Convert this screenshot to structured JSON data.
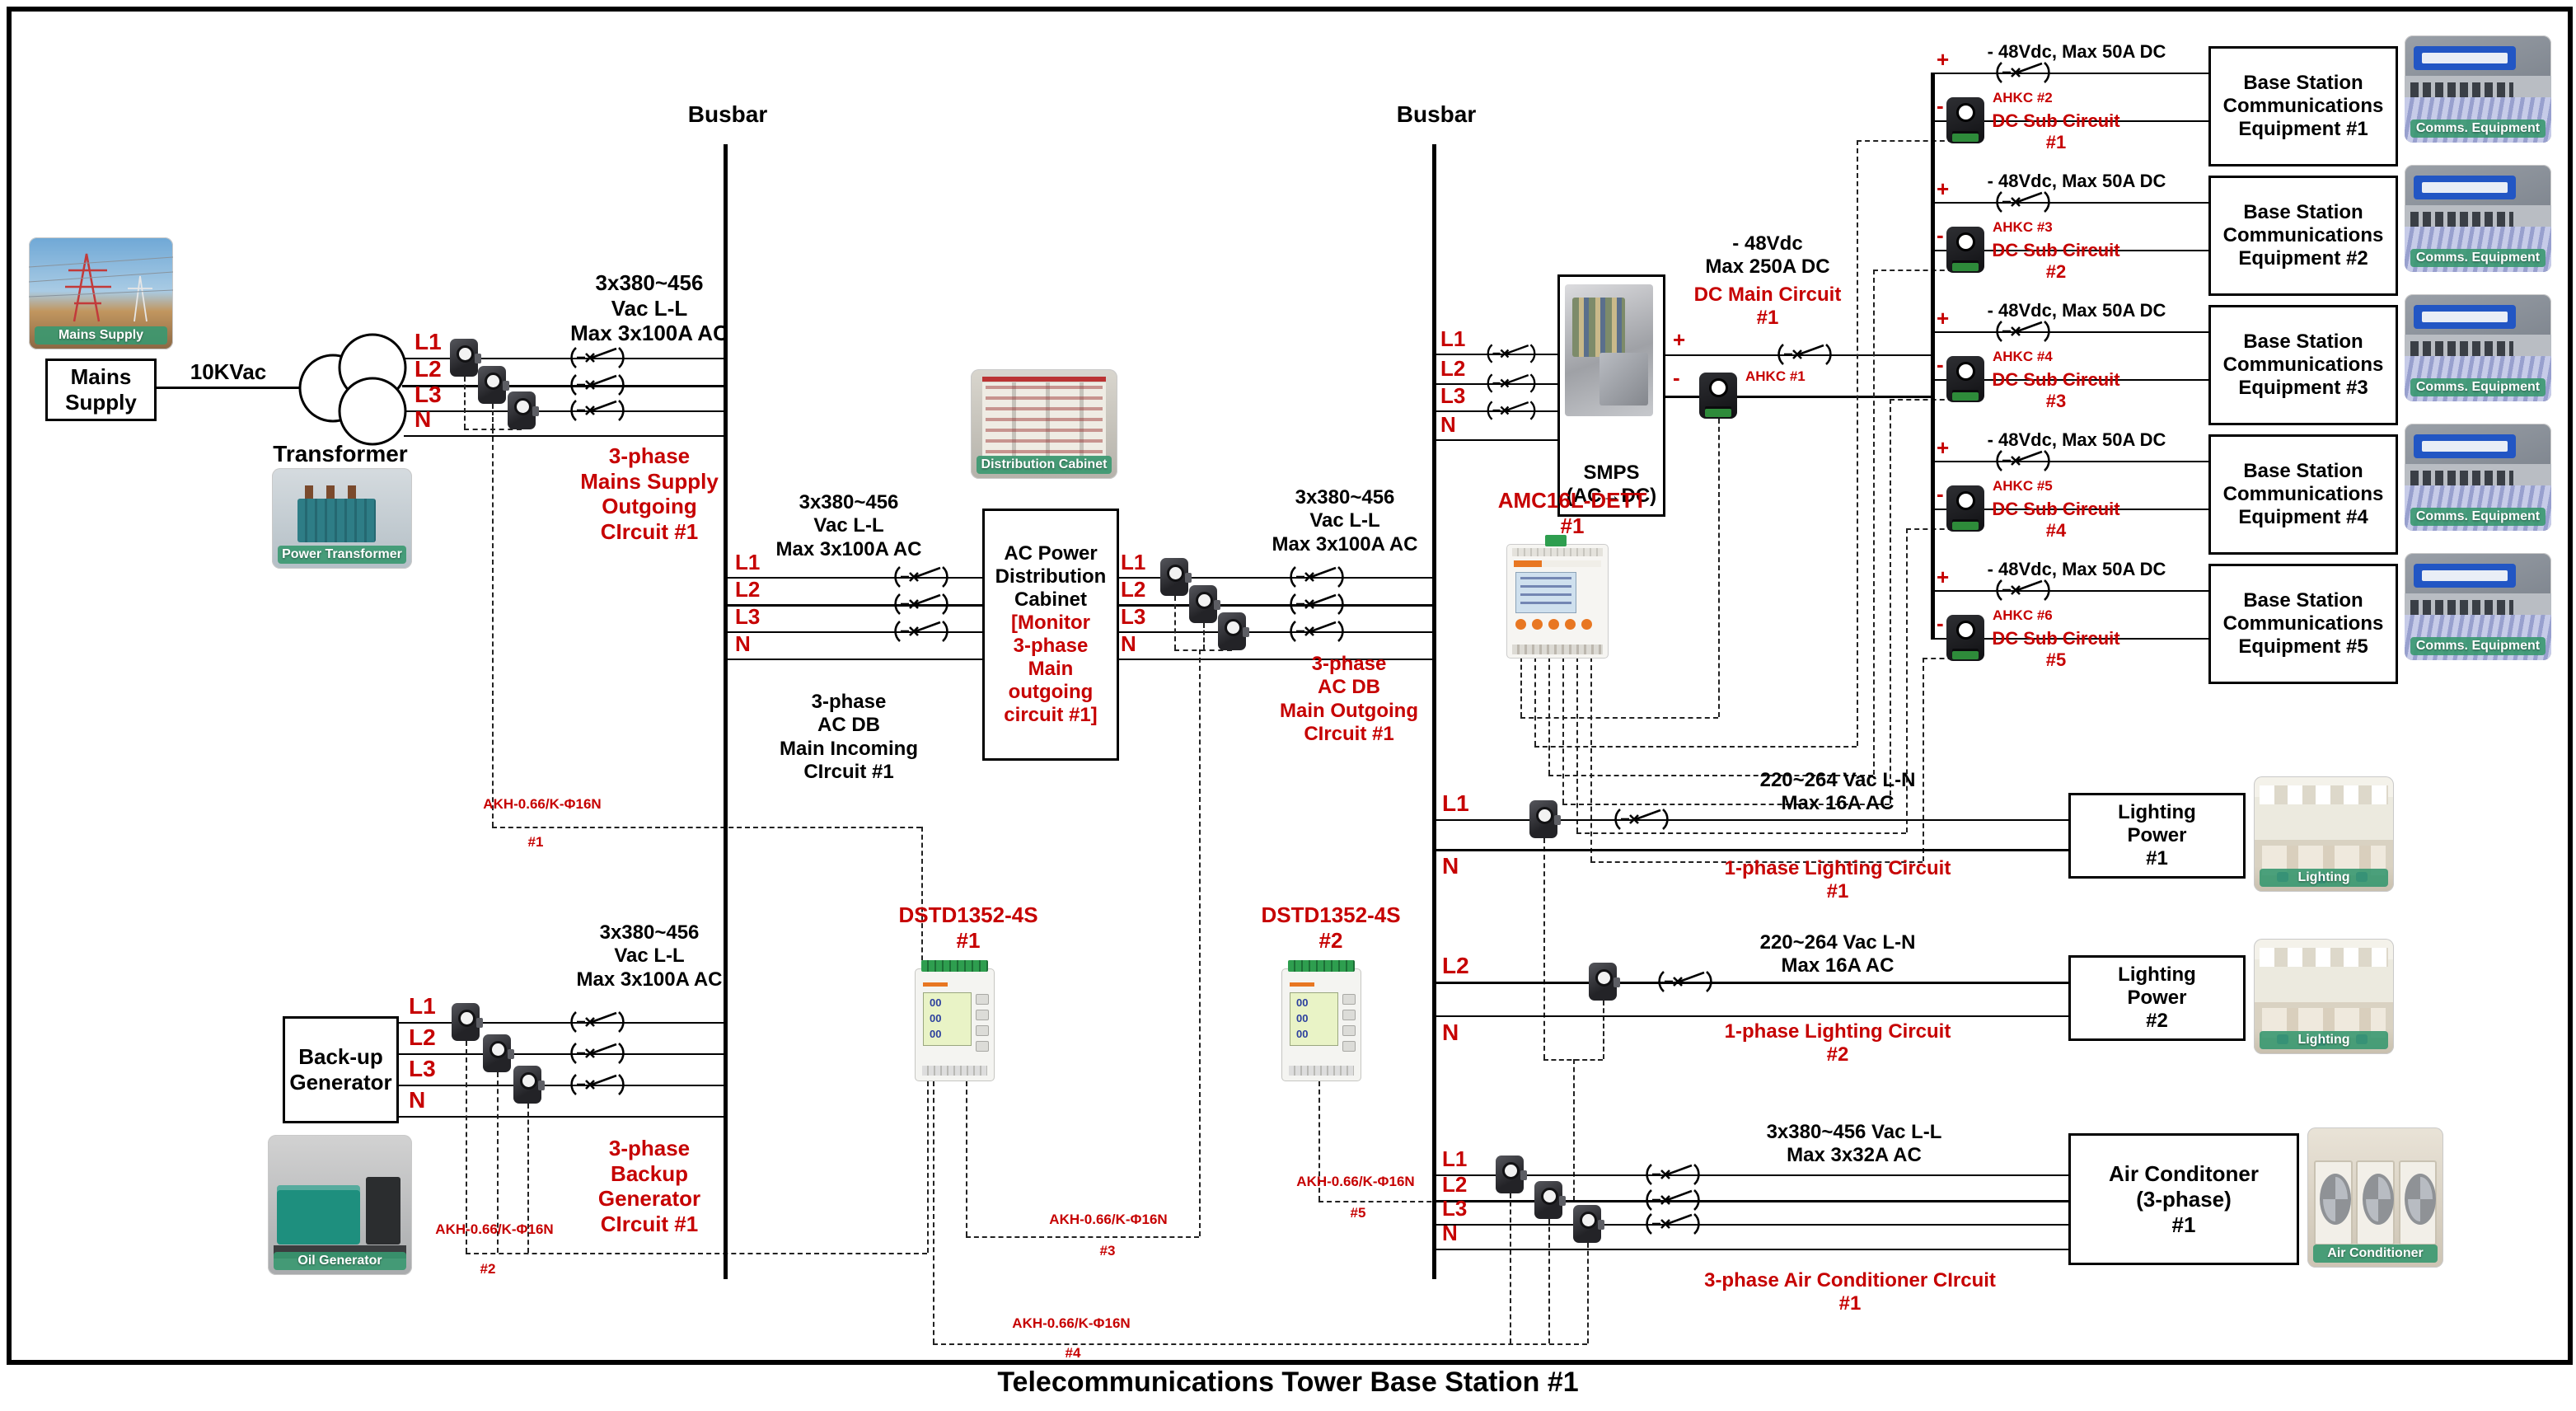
{
  "title": "Telecommunications Tower Base Station #1",
  "busbars": {
    "left": "Busbar",
    "right": "Busbar"
  },
  "mains": {
    "photo_caption": "Mains Supply",
    "source_box": "Mains\nSupply",
    "voltage": "10KVac",
    "transformer_label": "Transformer",
    "transformer_photo_caption": "Power Transformer",
    "l1": "L1",
    "l2": "L2",
    "l3": "L3",
    "n": "N",
    "rating": "3x380~456\nVac L-L\nMax 3x100A AC",
    "outgoing_label": "3-phase\nMains Supply\nOutgoing\nCIrcuit #1",
    "ct_label": "AKH-0.66/K-Φ16N",
    "ct_number": "#1"
  },
  "generator": {
    "box": "Back-up\nGenerator",
    "photo_caption": "Oil Generator",
    "l1": "L1",
    "l2": "L2",
    "l3": "L3",
    "n": "N",
    "rating": "3x380~456\nVac L-L\nMax 3x100A AC",
    "label": "3-phase\nBackup\nGenerator\nCIrcuit #1",
    "ct_label": "AKH-0.66/K-Φ16N",
    "ct_number": "#2"
  },
  "ac_db": {
    "photo_caption": "Distribution Cabinet",
    "box_title": "AC Power\nDistribution\nCabinet",
    "box_note": "[Monitor\n3-phase\nMain\noutgoing\ncircuit #1]",
    "in_l1": "L1",
    "in_l2": "L2",
    "in_l3": "L3",
    "in_n": "N",
    "out_l1": "L1",
    "out_l2": "L2",
    "out_l3": "L3",
    "out_n": "N",
    "in_rating": "3x380~456\nVac L-L\nMax 3x100A AC",
    "in_label": "3-phase\nAC DB\nMain Incoming\nCIrcuit #1",
    "out_rating": "3x380~456\nVac L-L\nMax 3x100A AC",
    "out_label": "3-phase\nAC DB\nMain Outgoing\nCIrcuit #1",
    "ct_label": "AKH-0.66/K-Φ16N",
    "ct_number": "#3"
  },
  "smps": {
    "box": "SMPS\n(AC→DC)",
    "l1": "L1",
    "l2": "L2",
    "l3": "L3",
    "n": "N",
    "plus": "+",
    "minus": "-"
  },
  "dc_main": {
    "rating": "- 48Vdc\nMax 250A DC",
    "label": "DC Main Circuit\n#1",
    "sensor": "AHKC #1"
  },
  "amc_meter": {
    "label": "AMC16L-DETT\n#1"
  },
  "dstd_meters": {
    "m1": "DSTD1352-4S\n#1",
    "m2": "DSTD1352-4S\n#2",
    "lcd": "00\n00\n00",
    "ct4_label": "AKH-0.66/K-Φ16N",
    "ct4_number": "#4",
    "ct5_label": "AKH-0.66/K-Φ16N",
    "ct5_number": "#5"
  },
  "dc_subs": [
    {
      "rating": "- 48Vdc, Max 50A DC",
      "plus": "+",
      "minus": "-",
      "sensor": "AHKC #2",
      "circuit": "DC Sub Circuit\n#1",
      "equipment": "Base Station\nCommunications\nEquipment #1",
      "photo_caption": "Comms. Equipment"
    },
    {
      "rating": "- 48Vdc, Max 50A DC",
      "plus": "+",
      "minus": "-",
      "sensor": "AHKC #3",
      "circuit": "DC Sub Circuit\n#2",
      "equipment": "Base Station\nCommunications\nEquipment #2",
      "photo_caption": "Comms. Equipment"
    },
    {
      "rating": "- 48Vdc, Max 50A DC",
      "plus": "+",
      "minus": "-",
      "sensor": "AHKC #4",
      "circuit": "DC Sub Circuit\n#3",
      "equipment": "Base Station\nCommunications\nEquipment #3",
      "photo_caption": "Comms. Equipment"
    },
    {
      "rating": "- 48Vdc, Max 50A DC",
      "plus": "+",
      "minus": "-",
      "sensor": "AHKC #5",
      "circuit": "DC Sub Circuit\n#4",
      "equipment": "Base Station\nCommunications\nEquipment #4",
      "photo_caption": "Comms. Equipment"
    },
    {
      "rating": "- 48Vdc, Max 50A DC",
      "plus": "+",
      "minus": "-",
      "sensor": "AHKC #6",
      "circuit": "DC Sub Circuit\n#5",
      "equipment": "Base Station\nCommunications\nEquipment #5",
      "photo_caption": "Comms. Equipment"
    }
  ],
  "lighting": [
    {
      "l": "L1",
      "n": "N",
      "rating": "220~264 Vac L-N\nMax 16A AC",
      "label": "1-phase Lighting Circuit\n#1",
      "box": "Lighting\nPower\n#1",
      "photo_caption": "Lighting"
    },
    {
      "l": "L2",
      "n": "N",
      "rating": "220~264 Vac L-N\nMax 16A AC",
      "label": "1-phase Lighting Circuit\n#2",
      "box": "Lighting\nPower\n#2",
      "photo_caption": "Lighting"
    }
  ],
  "aircon": {
    "l1": "L1",
    "l2": "L2",
    "l3": "L3",
    "n": "N",
    "rating": "3x380~456 Vac L-L\nMax 3x32A AC",
    "label": "3-phase Air Conditioner CIrcuit\n#1",
    "box": "Air Conditoner\n(3-phase)\n#1",
    "photo_caption": "Air Conditioner"
  }
}
